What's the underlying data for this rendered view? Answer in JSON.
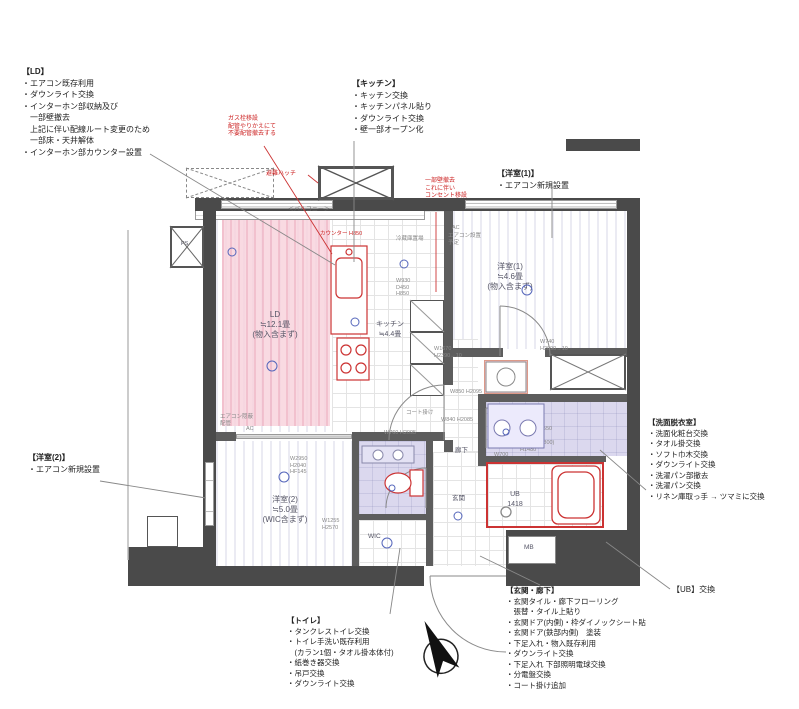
{
  "annotations": {
    "ld": {
      "title": "【LD】",
      "lines": [
        "・エアコン既存利用",
        "・ダウンライト交換",
        "・インターホン部収納及び",
        "　一部壁撤去",
        "　上記に伴い配線ルート変更のため",
        "　一部床・天井解体",
        "・インターホン部カウンター設置"
      ]
    },
    "kitchen": {
      "title": "【キッチン】",
      "lines": [
        "・キッチン交換",
        "・キッチンパネル貼り",
        "・ダウンライト交換",
        "・壁一部オープン化"
      ]
    },
    "western1": {
      "title": "【洋室(1)】",
      "lines": [
        "・エアコン新規設置"
      ]
    },
    "western2": {
      "title": "【洋室(2)】",
      "lines": [
        "・エアコン新規設置"
      ]
    },
    "washroom": {
      "title": "【洗面脱衣室】",
      "lines": [
        "・洗面化粧台交換",
        "・タオル掛交換",
        "・ソフト巾木交換",
        "・ダウンライト交換",
        "・洗濯パン部撤去",
        "・洗濯パン交換",
        "・リネン庫取っ手 → ツマミに交換"
      ]
    },
    "ub": {
      "label": "【UB】交換"
    },
    "entrance": {
      "title": "【玄関・廊下】",
      "lines": [
        "・玄関タイル・廊下フローリング",
        "　張替・タイル上貼り",
        "・玄関ドア(内側)・枠ダイノックシート貼",
        "・玄関ドア(鉄部内側)　塗装",
        "・下足入れ・物入既存利用",
        "・ダウンライト交換",
        "・下足入れ 下部照明電球交換",
        "・分電盤交換",
        "・コート掛け追加"
      ]
    },
    "toilet": {
      "title": "【トイレ】",
      "lines": [
        "・タンクレストイレ交換",
        "・トイレ手洗い既存利用",
        "　(カラン1個・タオル掛本体付)",
        "・紙巻き器交換",
        "・吊戸交換",
        "・ダウンライト交換"
      ]
    },
    "red_counter_note": {
      "lines": [
        "ガス栓移設",
        "配管やりかえにて",
        "不要配管撤去する"
      ]
    },
    "red_wall_note": {
      "lines": [
        "一部壁撤去",
        "これに伴い",
        "コンセント移設"
      ]
    },
    "hatch_label": "避難ハッチ"
  },
  "rooms": {
    "ld": {
      "label": "LD",
      "size": "≒12.1畳",
      "note": "(物入含まず)"
    },
    "kitchen": {
      "label": "キッチン",
      "size": "≒4.4畳"
    },
    "western1": {
      "label": "洋室(1)",
      "size": "≒4.6畳",
      "note": "(物入含まず)"
    },
    "western2": {
      "label": "洋室(2)",
      "size": "≒5.0畳",
      "note": "(WIC含まず)"
    },
    "washroom": {
      "label": "洗面室"
    },
    "ub": {
      "label": "UB",
      "size": "1418"
    },
    "hallway": {
      "label": "廊下"
    },
    "genkan": {
      "label": "玄関"
    },
    "wic": {
      "label": "WIC"
    },
    "mb": {
      "label": "MB"
    },
    "ps": {
      "label": "PS"
    }
  },
  "plan_labels": {
    "balcony": "＜バルコニー＞",
    "fridge": "冷蔵庫置場",
    "ac_badge": "AC",
    "ac_plan": "エアコン設置予定",
    "counter": "カウンター H850",
    "concealed_pipe": "エアコン隠蔽配管",
    "coat_hook": "コート掛け",
    "laundry_size": "640×640"
  },
  "specs": [
    "W1670 H2390→10",
    "W740 H2090→10",
    "W850 H2095",
    "W840 H2085",
    "W760 H2095",
    "W2950 H2040 HF145",
    "W1255 H2570",
    "W700",
    "W1200 D550 H1800",
    "(W750×H800) H1480",
    "W930 D450 H850",
    "W2740 D750"
  ],
  "colors": {
    "highlight_pink": "#f7cdd8",
    "highlight_purple": "#d9d6ec",
    "red": "#cc2222",
    "wall": "#4a4a4a",
    "symbol_blue": "#5566bb"
  }
}
